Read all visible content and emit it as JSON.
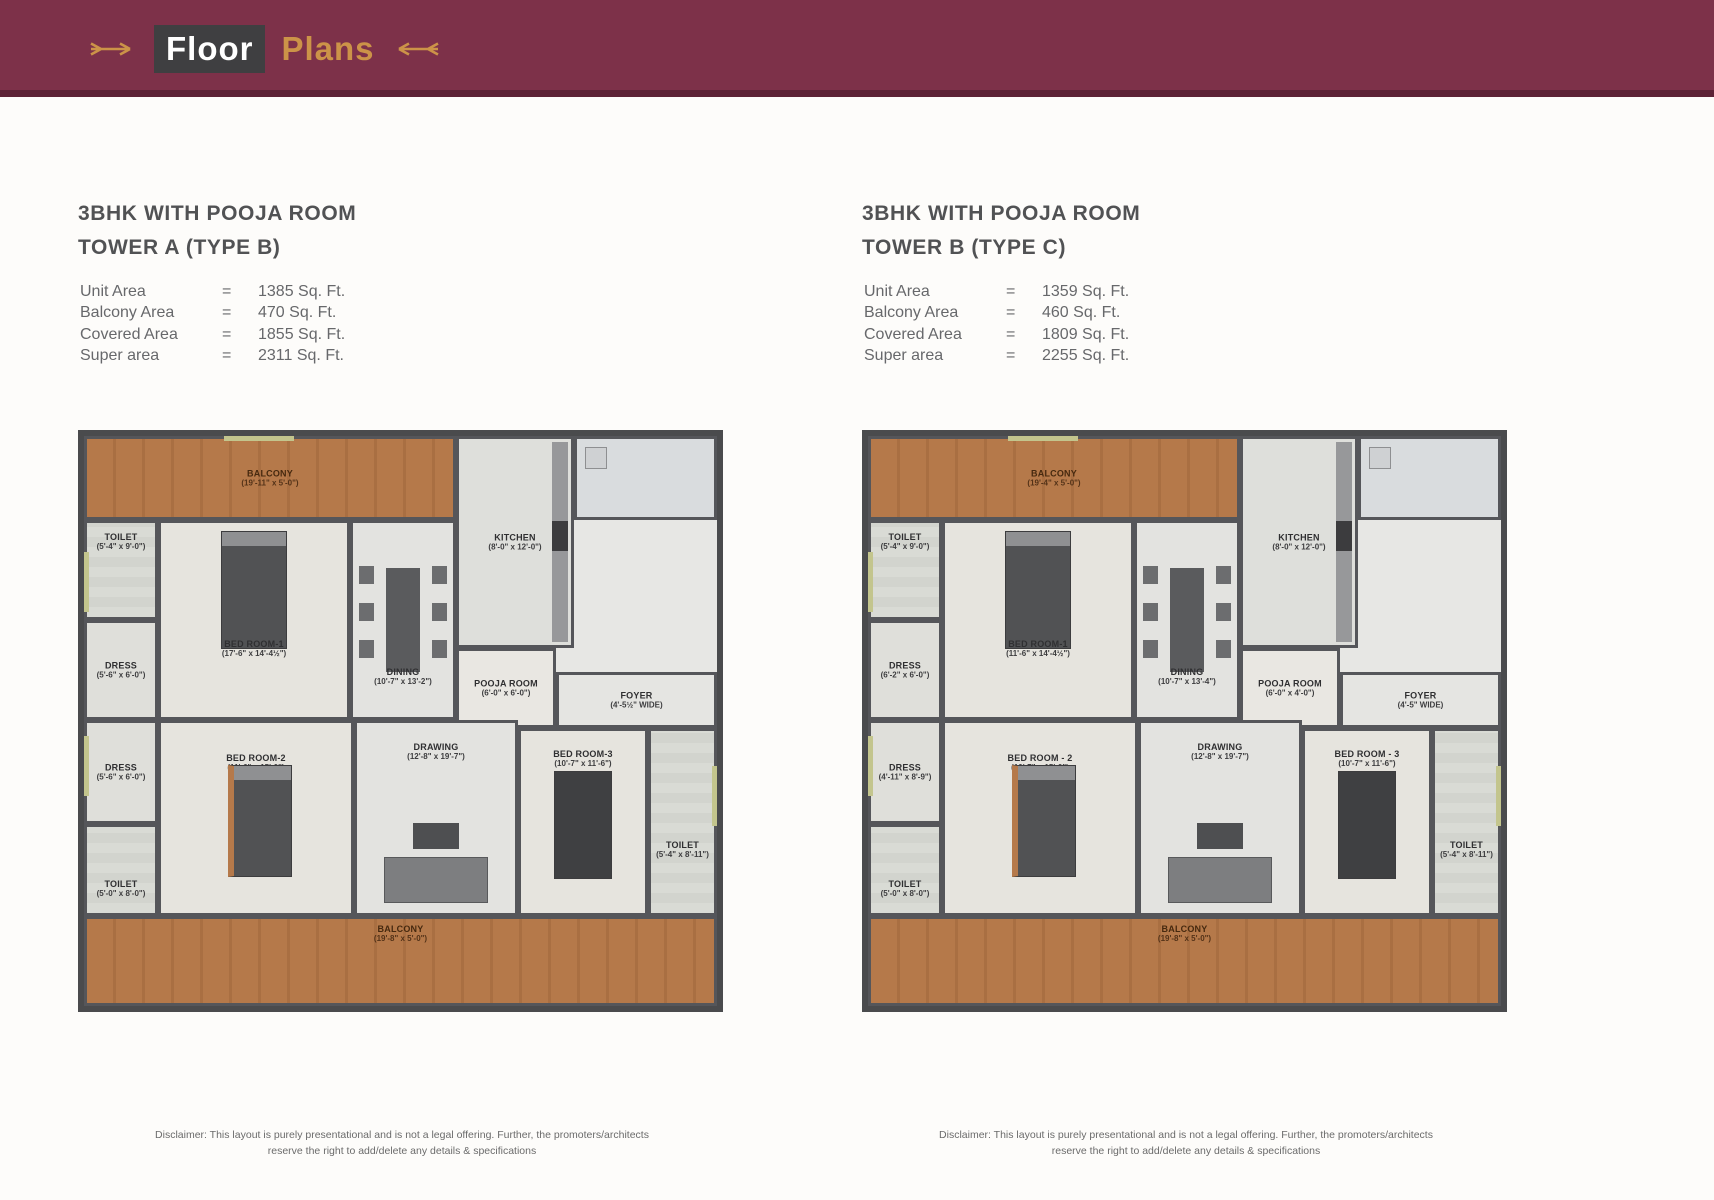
{
  "header": {
    "title_white": "Floor",
    "title_gold": "Plans"
  },
  "icons": {
    "header_left": "arrow-right-ornament-icon",
    "header_right": "arrow-left-ornament-icon"
  },
  "colors": {
    "header_band": "#7d3149",
    "header_band_edge": "#5d2236",
    "gold": "#cc9348",
    "floor_title_box": "#3f3f41",
    "wall": "#4a4b4d",
    "balcony_wood": "#b5794a",
    "olive_accent": "#c3c58d",
    "plan_floor": "#e7e7e4"
  },
  "plans": [
    {
      "title_line1": "3BHK WITH POOJA ROOM",
      "title_line2": "TOWER A (TYPE B)",
      "specs": [
        {
          "label": "Unit Area",
          "eq": "=",
          "value": "1385 Sq. Ft."
        },
        {
          "label": "Balcony Area",
          "eq": "=",
          "value": "470 Sq. Ft."
        },
        {
          "label": "Covered Area",
          "eq": "=",
          "value": "1855 Sq. Ft."
        },
        {
          "label": "Super area",
          "eq": "=",
          "value": "2311 Sq. Ft."
        }
      ],
      "rooms": {
        "balcony_top": {
          "name": "BALCONY",
          "dims": "(19'-11\" x 5'-0\")"
        },
        "kitchen": {
          "name": "KITCHEN",
          "dims": "(8'-0\" x 12'-0\")"
        },
        "toilet_top": {
          "name": "TOILET",
          "dims": "(5'-4\" x 9'-0\")"
        },
        "dress_top": {
          "name": "DRESS",
          "dims": "(5'-6\" x 6'-0\")"
        },
        "bedroom1": {
          "name": "BED ROOM-1",
          "dims": "(17'-6\" x 14'-4½\")"
        },
        "dining": {
          "name": "DINING",
          "dims": "(10'-7\" x 13'-2\")"
        },
        "pooja": {
          "name": "POOJA ROOM",
          "dims": "(6'-0\" x 6'-0\")"
        },
        "foyer": {
          "name": "FOYER",
          "dims": "(4'-5½\" WIDE)"
        },
        "dress_bottom": {
          "name": "DRESS",
          "dims": "(5'-6\" x 6'-0\")"
        },
        "bedroom2": {
          "name": "BED ROOM-2",
          "dims": "(11'-6\" x 15'-0\")"
        },
        "drawing": {
          "name": "DRAWING",
          "dims": "(12'-8\" x 19'-7\")"
        },
        "bedroom3": {
          "name": "BED ROOM-3",
          "dims": "(10'-7\" x 11'-6\")"
        },
        "toilet_bl": {
          "name": "TOILET",
          "dims": "(5'-0\" x 8'-0\")"
        },
        "toilet_br": {
          "name": "TOILET",
          "dims": "(5'-4\" x 8'-11\")"
        },
        "balcony_bottom": {
          "name": "BALCONY",
          "dims": "(19'-8\" x 5'-0\")"
        }
      },
      "disclaimer_line1": "Disclaimer: This layout is purely presentational and is not a legal offering. Further, the promoters/architects",
      "disclaimer_line2": "reserve the right to add/delete any details & specifications"
    },
    {
      "title_line1": "3BHK WITH POOJA ROOM",
      "title_line2": "TOWER B (TYPE C)",
      "specs": [
        {
          "label": "Unit Area",
          "eq": "=",
          "value": "1359 Sq. Ft."
        },
        {
          "label": "Balcony Area",
          "eq": "=",
          "value": "460 Sq. Ft."
        },
        {
          "label": "Covered Area",
          "eq": "=",
          "value": "1809 Sq. Ft."
        },
        {
          "label": "Super area",
          "eq": "=",
          "value": "2255 Sq. Ft."
        }
      ],
      "rooms": {
        "balcony_top": {
          "name": "BALCONY",
          "dims": "(19'-4\" x 5'-0\")"
        },
        "kitchen": {
          "name": "KITCHEN",
          "dims": "(8'-0\" x 12'-0\")"
        },
        "toilet_top": {
          "name": "TOILET",
          "dims": "(5'-4\" x 9'-0\")"
        },
        "dress_top": {
          "name": "DRESS",
          "dims": "(6'-2\" x 6'-0\")"
        },
        "bedroom1": {
          "name": "BED ROOM-1",
          "dims": "(11'-6\" x 14'-4½\")"
        },
        "dining": {
          "name": "DINING",
          "dims": "(10'-7\" x 13'-4\")"
        },
        "pooja": {
          "name": "POOJA ROOM",
          "dims": "(6'-0\" x 4'-0\")"
        },
        "foyer": {
          "name": "FOYER",
          "dims": "(4'-5\" WIDE)"
        },
        "dress_bottom": {
          "name": "DRESS",
          "dims": "(4'-11\" x 8'-9\")"
        },
        "bedroom2": {
          "name": "BED ROOM - 2",
          "dims": "(10'-7\" x 15'-0\")"
        },
        "drawing": {
          "name": "DRAWING",
          "dims": "(12'-8\" x 19'-7\")"
        },
        "bedroom3": {
          "name": "BED ROOM - 3",
          "dims": "(10'-7\" x 11'-6\")"
        },
        "toilet_bl": {
          "name": "TOILET",
          "dims": "(5'-0\" x 8'-0\")"
        },
        "toilet_br": {
          "name": "TOILET",
          "dims": "(5'-4\" x 8'-11\")"
        },
        "balcony_bottom": {
          "name": "BALCONY",
          "dims": "(19'-8\" x 5'-0\")"
        }
      },
      "disclaimer_line1": "Disclaimer: This layout is purely presentational and is not a legal offering. Further, the promoters/architects",
      "disclaimer_line2": "reserve the right to add/delete any details & specifications"
    }
  ]
}
